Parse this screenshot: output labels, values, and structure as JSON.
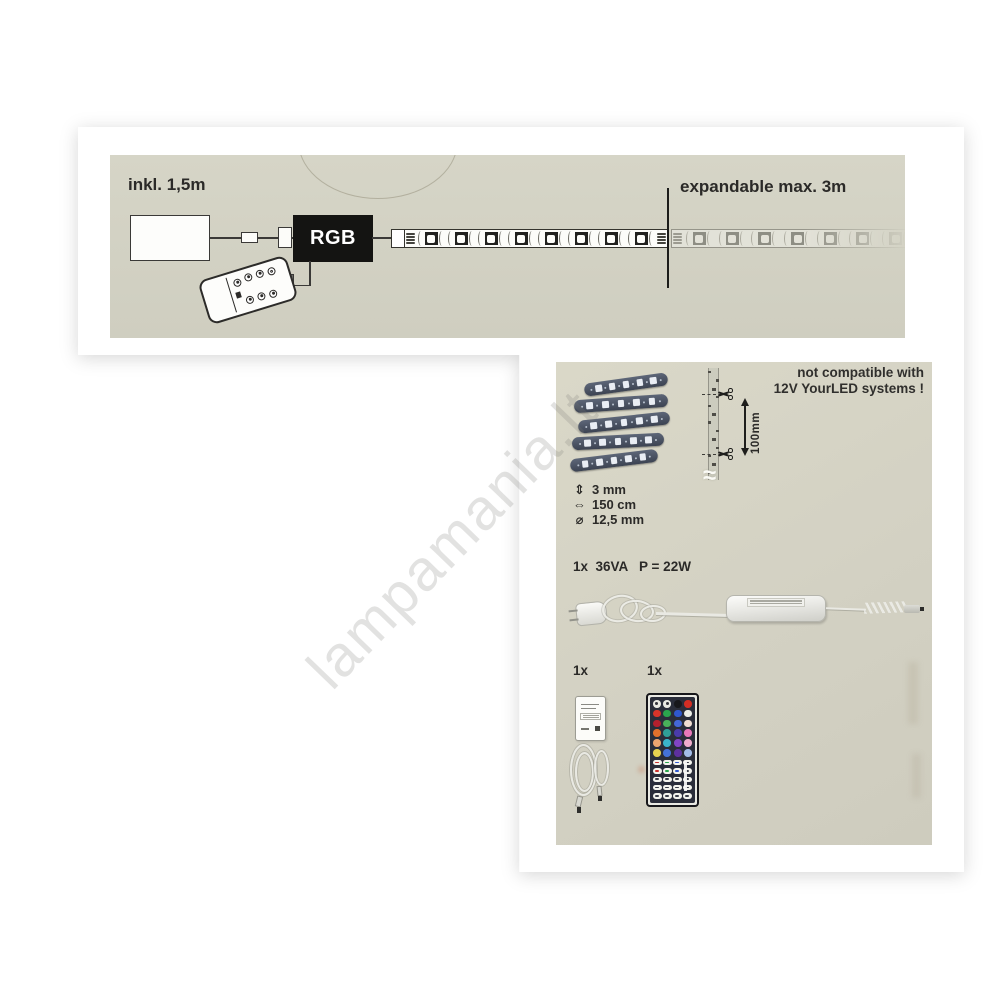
{
  "watermark": "lampamania.lt",
  "colors": {
    "panel_beige": "#d4d2c4",
    "ink": "#2b2a28",
    "rgb_controller_box": "#141412",
    "strip_led_dark": "#21211f",
    "coil_strip": "#4a5261"
  },
  "top_panel": {
    "included_label": "inkl. 1,5m",
    "rgb_label": "RGB",
    "expandable_label": "expandable max. 3m"
  },
  "bottom_panel": {
    "not_compatible_line1": "not compatible with",
    "not_compatible_line2": "12V YourLED systems !",
    "cut_length_label": "100mm",
    "break_symbol": "≈",
    "specs": [
      {
        "icon": "height-double-arrow-icon",
        "glyph": "⇕",
        "value": "3 mm"
      },
      {
        "icon": "width-double-arrow-icon",
        "glyph": "⇔",
        "value": "150 cm"
      },
      {
        "icon": "diameter-icon",
        "glyph": "⌀",
        "value": "12,5 mm"
      }
    ],
    "power_supply_label": "1x  36VA   P = 22W",
    "controller_qty_label": "1x",
    "remote_qty_label": "1x"
  },
  "remote_44key": {
    "color_rows": [
      [
        "#e9e9e3",
        "#e9e9e3",
        "#17171b",
        "#d22d24"
      ],
      [
        "#d8342a",
        "#2aa44d",
        "#2f58cf",
        "#edeee8"
      ],
      [
        "#b5202e",
        "#49b05a",
        "#4467d8",
        "#f0ddd2"
      ],
      [
        "#e2702c",
        "#2f9f97",
        "#4a3bab",
        "#e877ba"
      ],
      [
        "#eda570",
        "#3ab5cb",
        "#8144c4",
        "#f0accc"
      ],
      [
        "#e6d150",
        "#4472da",
        "#5e309f",
        "#a3bce9"
      ]
    ],
    "function_rows": [
      [
        "#c9302c",
        "#2aa44d",
        "#2f58cf",
        null
      ],
      [
        "#c9302c",
        "#2aa44d",
        "#2f58cf",
        null
      ],
      [
        null,
        null,
        null,
        null
      ],
      [
        null,
        null,
        null,
        null
      ],
      [
        null,
        null,
        null,
        null
      ]
    ]
  }
}
